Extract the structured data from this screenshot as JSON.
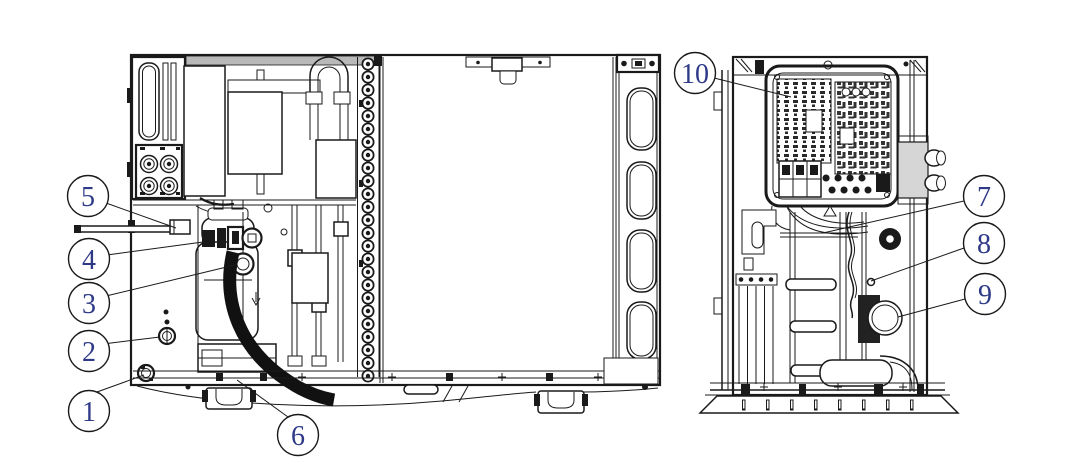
{
  "diagram": {
    "description": "Technical line drawing of a heat pump outdoor unit shown in two internal side views, with numbered circle callouts marking components",
    "views": [
      {
        "id": "left-view",
        "callouts_shown": [
          "1",
          "2",
          "3",
          "4",
          "5",
          "6"
        ]
      },
      {
        "id": "right-view",
        "callouts_shown": [
          "7",
          "8",
          "9",
          "10"
        ]
      }
    ]
  },
  "colors": {
    "background": "#ffffff",
    "line": "#1a1a1a",
    "callout_number": "#2e3a87"
  },
  "callouts": [
    {
      "label": "1"
    },
    {
      "label": "2"
    },
    {
      "label": "3"
    },
    {
      "label": "4"
    },
    {
      "label": "5"
    },
    {
      "label": "6"
    },
    {
      "label": "7"
    },
    {
      "label": "8"
    },
    {
      "label": "9"
    },
    {
      "label": "10"
    }
  ]
}
